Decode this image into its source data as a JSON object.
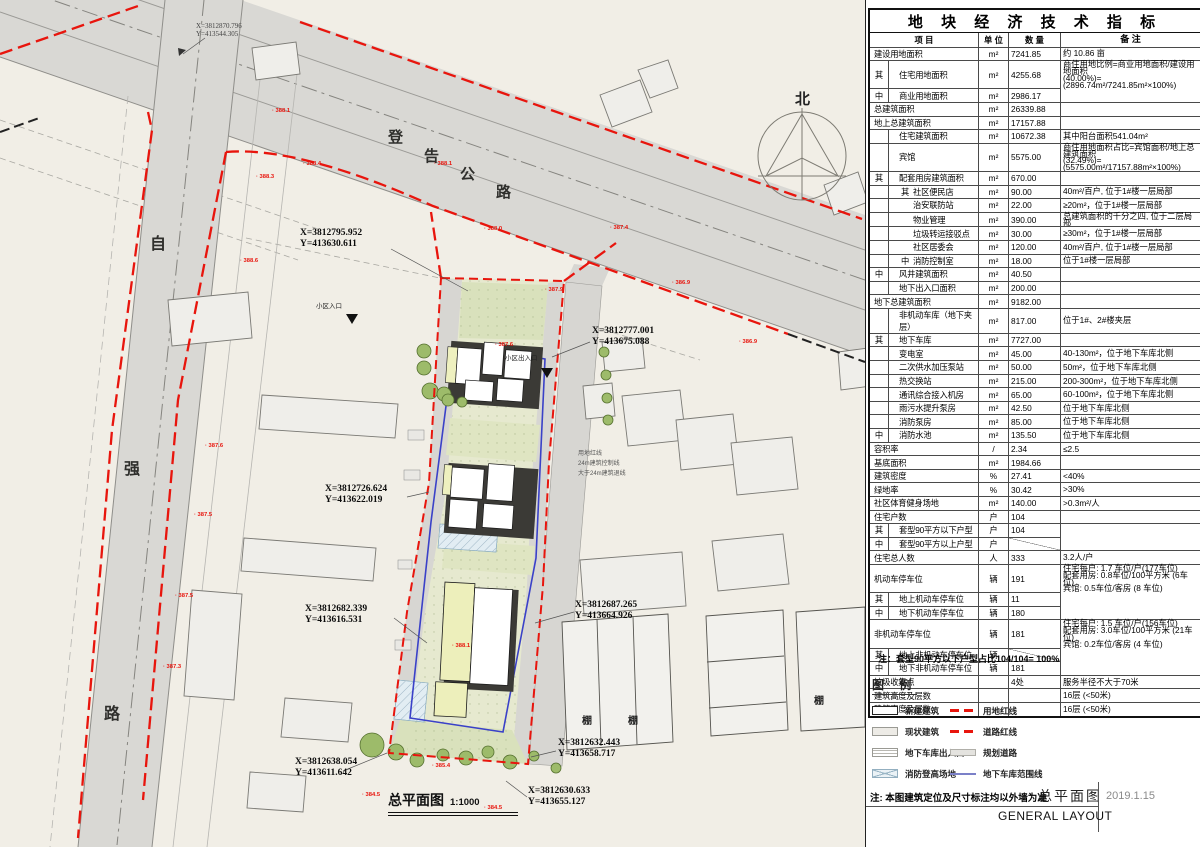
{
  "table": {
    "title": "地 块 经 济 技 术 指 标",
    "headers": {
      "item": "项            目",
      "unit": "单 位",
      "qty": "数   量",
      "note": "备  注"
    },
    "rows": [
      {
        "item": "建设用地面积",
        "lvl": 0,
        "unit": "m²",
        "qty": "7241.85",
        "note": "约 10.86 亩"
      },
      {
        "g": "其",
        "item": "住宅用地面积",
        "lvl": 1,
        "unit": "m²",
        "qty": "4255.68",
        "note": "商住用地比例=商业用地面积/建设用地面积\n(40.00%)=(2896.74m²/7241.85m²×100%)"
      },
      {
        "g": "中",
        "item": "商业用地面积",
        "lvl": 1,
        "unit": "m²",
        "qty": "2986.17",
        "note": "",
        "m": 1
      },
      {
        "item": "总建筑面积",
        "lvl": 0,
        "unit": "m²",
        "qty": "26339.88",
        "note": ""
      },
      {
        "item": "地上总建筑面积",
        "lvl": 0,
        "unit": "m²",
        "qty": "17157.88",
        "note": ""
      },
      {
        "item": "住宅建筑面积",
        "lvl": 1,
        "unit": "m²",
        "qty": "10672.38",
        "note": "其中阳台面积541.04m²"
      },
      {
        "item": "宾馆",
        "lvl": 1,
        "unit": "m²",
        "qty": "5575.00",
        "note": "商住用地面积占比=宾馆面积/地上总建筑面积\n(32.49%)=(5575.00m²/17157.88m²×100%)"
      },
      {
        "g": "其",
        "item": "配套用房建筑面积",
        "lvl": 1,
        "unit": "m²",
        "qty": "670.00",
        "note": ""
      },
      {
        "g2": "其",
        "item": "社区便民店",
        "lvl": 2,
        "unit": "m²",
        "qty": "90.00",
        "note": "40m²/百户, 位于1#楼一层局部"
      },
      {
        "item": "治安联防站",
        "lvl": 2,
        "unit": "m²",
        "qty": "22.00",
        "note": "≥20m²，位于1#楼一层局部"
      },
      {
        "item": "物业管理",
        "lvl": 2,
        "unit": "m²",
        "qty": "390.00",
        "note": "总建筑面积的千分之四, 位于二层局部"
      },
      {
        "item": "垃圾转运接驳点",
        "lvl": 2,
        "unit": "m²",
        "qty": "30.00",
        "note": "≥30m²，位于1#楼一层局部"
      },
      {
        "item": "社区居委会",
        "lvl": 2,
        "unit": "m²",
        "qty": "120.00",
        "note": "40m²/百户, 位于1#楼一层局部"
      },
      {
        "g2": "中",
        "item": "消防控制室",
        "lvl": 2,
        "unit": "m²",
        "qty": "18.00",
        "note": "位于1#楼一层局部"
      },
      {
        "g": "中",
        "item": "风井建筑面积",
        "lvl": 1,
        "unit": "m²",
        "qty": "40.50",
        "note": ""
      },
      {
        "item": "地下出入口面积",
        "lvl": 1,
        "unit": "m²",
        "qty": "200.00",
        "note": ""
      },
      {
        "item": "地下总建筑面积",
        "lvl": 0,
        "unit": "m²",
        "qty": "9182.00",
        "note": ""
      },
      {
        "item": "非机动车库（地下夹层）",
        "lvl": 1,
        "unit": "m²",
        "qty": "817.00",
        "note": "位于1#、2#楼夹层"
      },
      {
        "g": "其",
        "item": "地下车库",
        "lvl": 1,
        "unit": "m²",
        "qty": "7727.00",
        "note": ""
      },
      {
        "item": "变电室",
        "lvl": 1,
        "unit": "m²",
        "qty": "45.00",
        "note": "40-130m²，位于地下车库北侧"
      },
      {
        "item": "二次供水加压泵站",
        "lvl": 1,
        "unit": "m²",
        "qty": "50.00",
        "note": "50m²，位于地下车库北侧"
      },
      {
        "item": "热交换站",
        "lvl": 1,
        "unit": "m²",
        "qty": "215.00",
        "note": "200-300m²，位于地下车库北侧"
      },
      {
        "item": "通讯综合接入机房",
        "lvl": 1,
        "unit": "m²",
        "qty": "65.00",
        "note": "60-100m²，位于地下车库北侧"
      },
      {
        "item": "雨污水提升泵房",
        "lvl": 1,
        "unit": "m²",
        "qty": "42.50",
        "note": "位于地下车库北侧"
      },
      {
        "item": "消防泵房",
        "lvl": 1,
        "unit": "m²",
        "qty": "85.00",
        "note": "位于地下车库北侧"
      },
      {
        "g": "中",
        "item": "消防水池",
        "lvl": 1,
        "unit": "m²",
        "qty": "135.50",
        "note": "位于地下车库北侧"
      },
      {
        "item": "容积率",
        "lvl": 0,
        "unit": "/",
        "qty": "2.34",
        "note": "≤2.5"
      },
      {
        "item": "基底面积",
        "lvl": 0,
        "unit": "m²",
        "qty": "1984.66",
        "note": ""
      },
      {
        "item": "建筑密度",
        "lvl": 0,
        "unit": "%",
        "qty": "27.41",
        "note": "<40%"
      },
      {
        "item": "绿地率",
        "lvl": 0,
        "unit": "%",
        "qty": "30.42",
        "note": ">30%"
      },
      {
        "item": "社区体育健身场地",
        "lvl": 0,
        "unit": "m²",
        "qty": "140.00",
        "note": ">0.3m²/人"
      },
      {
        "item": "住宅户数",
        "lvl": 0,
        "unit": "户",
        "qty": "104",
        "note": ""
      },
      {
        "g": "其",
        "item": "套型90平方以下户型",
        "lvl": 1,
        "unit": "户",
        "qty": "104",
        "note": ""
      },
      {
        "g": "中",
        "item": "套型90平方以上户型",
        "lvl": 1,
        "unit": "户",
        "qty": "",
        "slash": 1,
        "note": "",
        "m": 1
      },
      {
        "item": "住宅总人数",
        "lvl": 0,
        "unit": "人",
        "qty": "333",
        "note": "3.2人/户"
      },
      {
        "item": "机动车停车位",
        "lvl": 0,
        "unit": "辆",
        "qty": "191",
        "note": "住宅每户: 1.7 车位/户(177车位)\n配套用房: 0.8车位/100平方米 (6车位)\n宾馆: 0.5车位/客房 (8 车位)"
      },
      {
        "g": "其",
        "item": "地上机动车停车位",
        "lvl": 1,
        "unit": "辆",
        "qty": "11",
        "note": "",
        "m": 1
      },
      {
        "g": "中",
        "item": "地下机动车停车位",
        "lvl": 1,
        "unit": "辆",
        "qty": "180",
        "note": "",
        "m": 1
      },
      {
        "item": "非机动车停车位",
        "lvl": 0,
        "unit": "辆",
        "qty": "181",
        "note": "住宅每户: 1.5 车位/户(156车位)\n配套用房: 3.0车位/100平方米 (21车位)\n宾馆: 0.2车位/客房 (4 车位)"
      },
      {
        "g": "其",
        "item": "地上非机动车停车位",
        "lvl": 1,
        "unit": "辆",
        "qty": "",
        "slash": 1,
        "note": "",
        "m": 1
      },
      {
        "g": "中",
        "item": "地下非机动车停车位",
        "lvl": 1,
        "unit": "辆",
        "qty": "181",
        "note": "",
        "m": 1
      },
      {
        "item": "垃圾收集点",
        "lvl": 0,
        "unit": "",
        "qty": "4处",
        "note": "服务半径不大于70米"
      },
      {
        "item": "建筑高度及层数",
        "lvl": 0,
        "unit": "",
        "qty": "",
        "note": "16层 (<50米)"
      },
      {
        "item": "建筑高度及层数",
        "lvl": 0,
        "unit": "",
        "qty": "",
        "note": "16层 (<50米)"
      }
    ],
    "footnote": "注：套型90平方以下户型占比104/104= 100%"
  },
  "legend": {
    "title": "图  例",
    "items_left": [
      {
        "label": "新建建筑",
        "symbol": "new-building"
      },
      {
        "label": "现状建筑",
        "symbol": "existing-building"
      },
      {
        "label": "地下车库出入口",
        "symbol": "garage-entrance"
      },
      {
        "label": "消防登高场地",
        "symbol": "fire-area"
      }
    ],
    "items_right": [
      {
        "label": "用地红线",
        "symbol": "red-dash-bold"
      },
      {
        "label": "道路红线",
        "symbol": "red-dash"
      },
      {
        "label": "规划道路",
        "symbol": "planned-road"
      },
      {
        "label": "地下车库范围线",
        "symbol": "blue-line"
      }
    ]
  },
  "titleblock": {
    "note": "注: 本图建筑定位及尺寸标注均以外墙为准",
    "title_cn": "总平面图",
    "title_en": "GENERAL LAYOUT",
    "date": "2019.1.15"
  },
  "plan": {
    "north_label": "北",
    "road_top_chars": [
      "登",
      "告",
      "公",
      "路"
    ],
    "road_left_chars": [
      "自",
      "强",
      "路"
    ],
    "scale_title": {
      "cn": "总平面图",
      "scale": "1:1000"
    },
    "entrance_labels": [
      {
        "text": "小区入口",
        "x": 316,
        "y": 300
      },
      {
        "text": "小区出入口",
        "x": 505,
        "y": 352
      }
    ],
    "setback_labels": [
      "用地红线",
      "24m建筑控制线",
      "大于24m建筑退线"
    ],
    "shed_labels": [
      {
        "text": "棚",
        "x": 582,
        "y": 712
      },
      {
        "text": "棚",
        "x": 628,
        "y": 712
      },
      {
        "text": "棚",
        "x": 814,
        "y": 692
      }
    ],
    "coordinates": [
      {
        "x": "X=3812870.796",
        "y": "Y=413544.305",
        "left": 196,
        "top": 22,
        "small": 1
      },
      {
        "x": "X=3812795.952",
        "y": "Y=413630.611",
        "left": 300,
        "top": 228
      },
      {
        "x": "X=3812777.001",
        "y": "Y=413675.088",
        "left": 592,
        "top": 326
      },
      {
        "x": "X=3812726.624",
        "y": "Y=413622.019",
        "left": 325,
        "top": 484
      },
      {
        "x": "X=3812682.339",
        "y": "Y=413616.531",
        "left": 305,
        "top": 604
      },
      {
        "x": "X=3812687.265",
        "y": "Y=413664.926",
        "left": 575,
        "top": 600
      },
      {
        "x": "X=3812632.443",
        "y": "Y=413658.717",
        "left": 558,
        "top": 738
      },
      {
        "x": "X=3812638.054",
        "y": "Y=413611.642",
        "left": 295,
        "top": 757
      },
      {
        "x": "X=3812630.633",
        "y": "Y=413655.127",
        "left": 528,
        "top": 786
      }
    ],
    "elevations": [
      {
        "v": "388.1",
        "x": 272,
        "y": 108
      },
      {
        "v": "388.4",
        "x": 303,
        "y": 161
      },
      {
        "v": "388.3",
        "x": 256,
        "y": 174
      },
      {
        "v": "388.6",
        "x": 240,
        "y": 258
      },
      {
        "v": "388.1",
        "x": 434,
        "y": 161
      },
      {
        "v": "388.0",
        "x": 484,
        "y": 226
      },
      {
        "v": "387.4",
        "x": 610,
        "y": 225
      },
      {
        "v": "387.9",
        "x": 545,
        "y": 287
      },
      {
        "v": "386.9",
        "x": 672,
        "y": 280
      },
      {
        "v": "386.9",
        "x": 739,
        "y": 339
      },
      {
        "v": "387.6",
        "x": 495,
        "y": 342
      },
      {
        "v": "387.6",
        "x": 205,
        "y": 443
      },
      {
        "v": "387.5",
        "x": 194,
        "y": 512
      },
      {
        "v": "387.5",
        "x": 175,
        "y": 593
      },
      {
        "v": "387.3",
        "x": 163,
        "y": 664
      },
      {
        "v": "388.1",
        "x": 452,
        "y": 643
      },
      {
        "v": "385.4",
        "x": 432,
        "y": 763
      },
      {
        "v": "384.5",
        "x": 362,
        "y": 792
      },
      {
        "v": "384.5",
        "x": 484,
        "y": 805
      }
    ]
  }
}
